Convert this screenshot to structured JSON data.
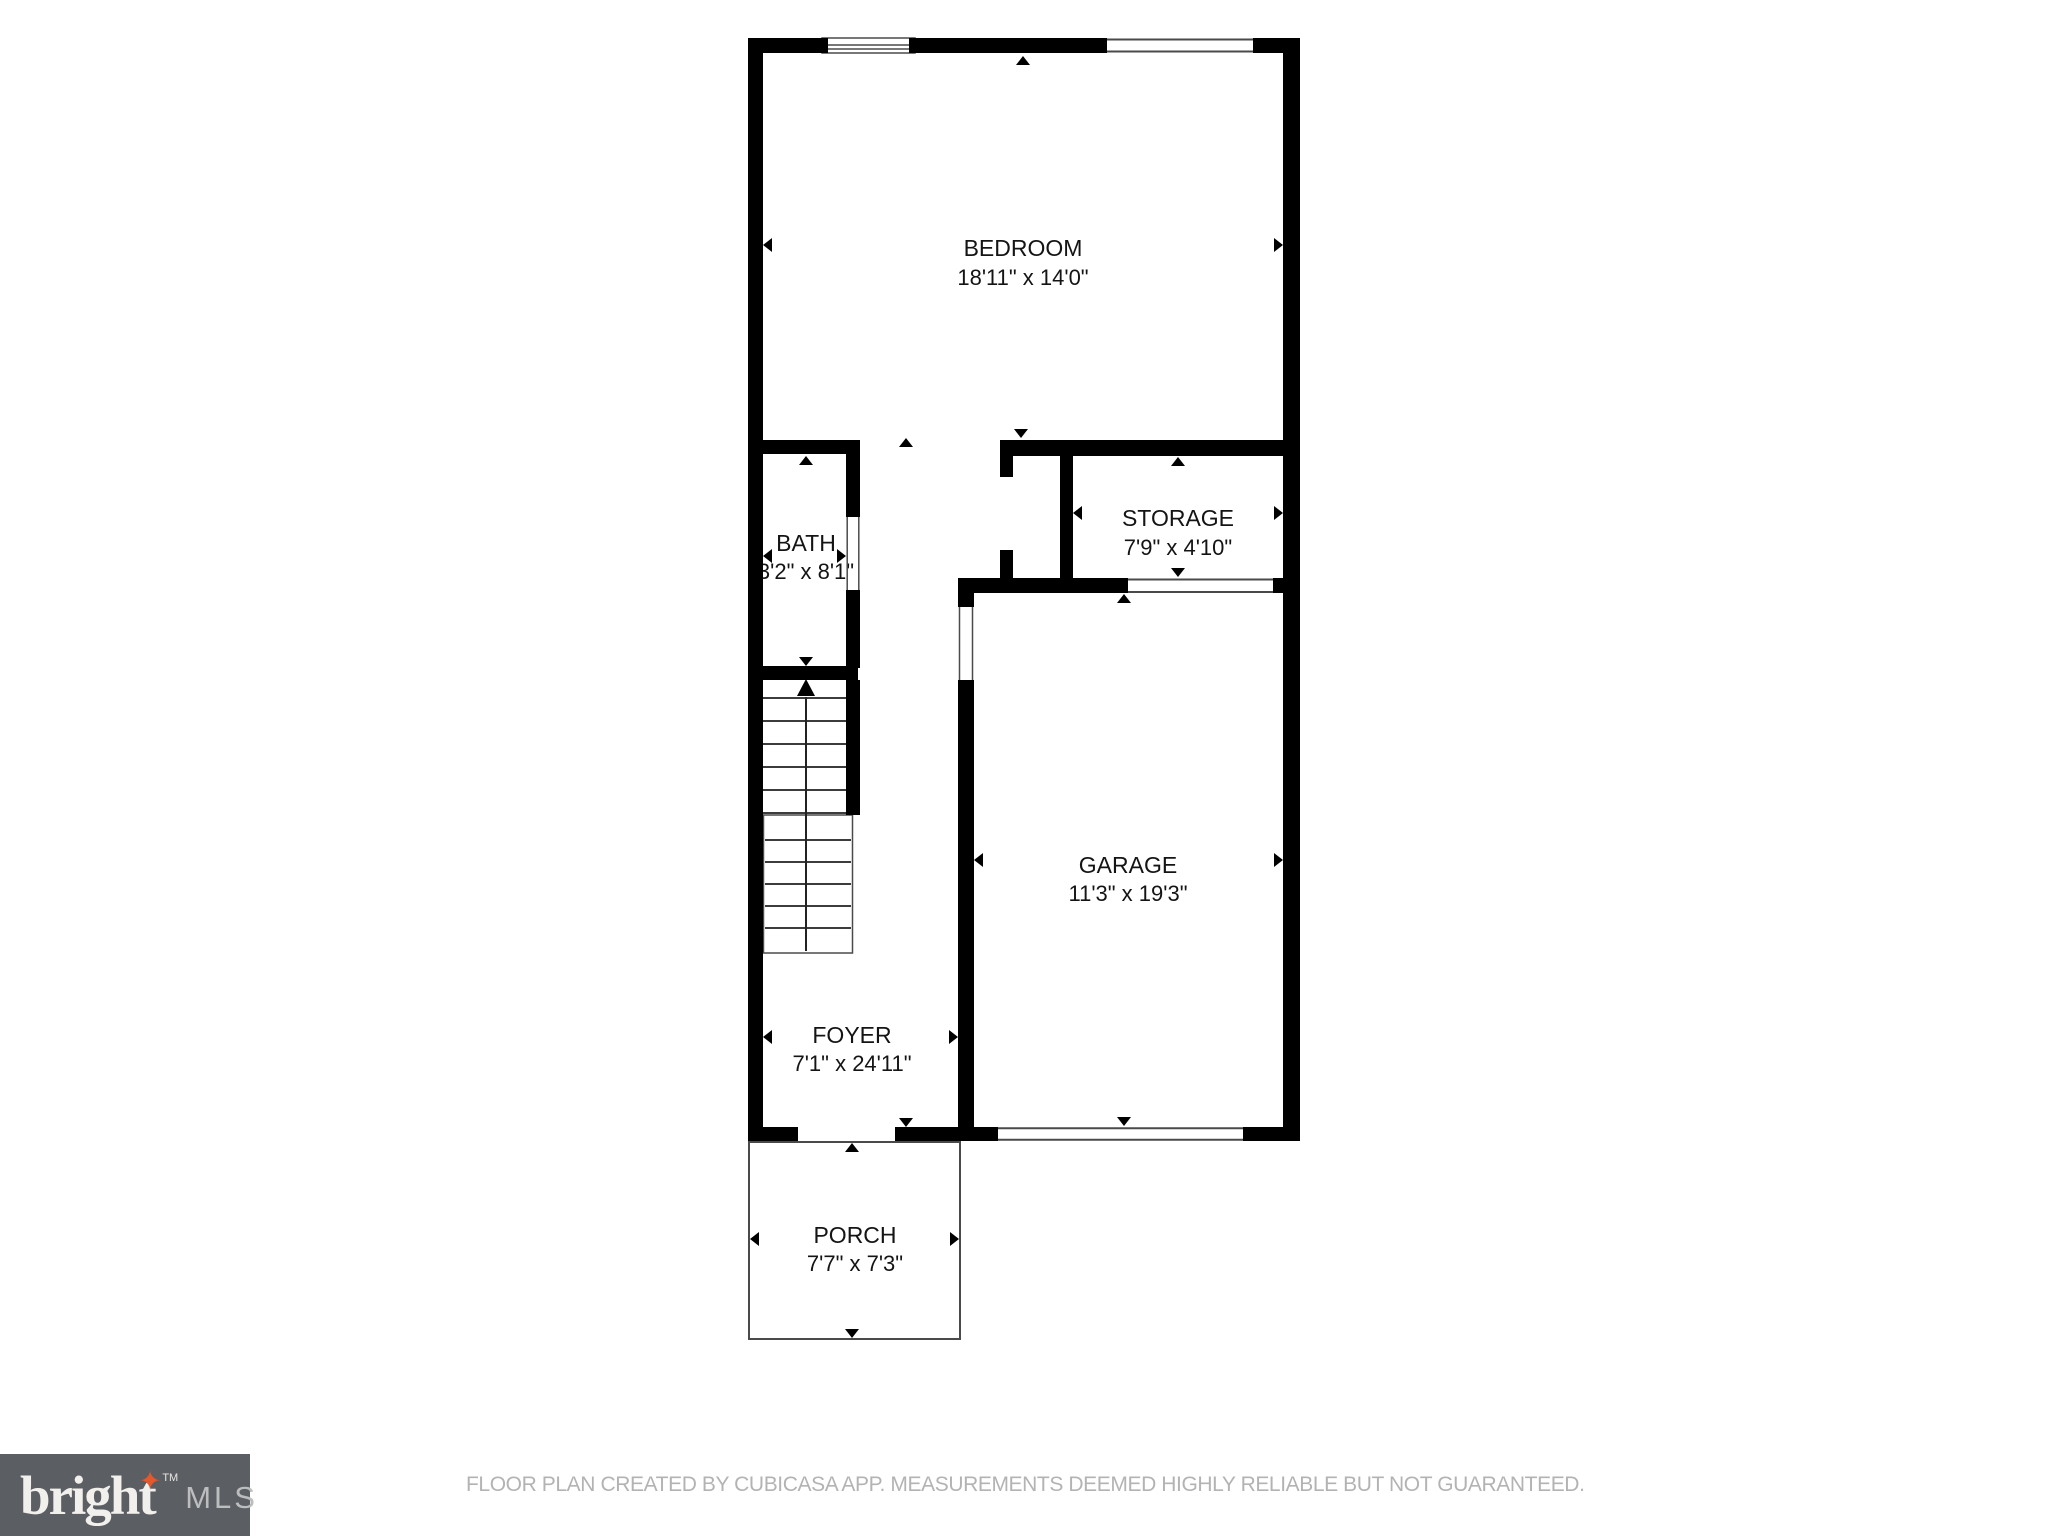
{
  "plan": {
    "source": "floor-plan",
    "rooms": [
      {
        "name": "BEDROOM",
        "dims": "18'11\" x 14'0\""
      },
      {
        "name": "BATH",
        "dims": "3'2\" x 8'1\""
      },
      {
        "name": "STORAGE",
        "dims": "7'9\" x 4'10\""
      },
      {
        "name": "GARAGE",
        "dims": "11'3\" x 19'3\""
      },
      {
        "name": "FOYER",
        "dims": "7'1\" x 24'11\""
      },
      {
        "name": "PORCH",
        "dims": "7'7\" x 7'3\""
      }
    ]
  },
  "branding": {
    "brand": "bright",
    "trademark": "TM",
    "star_icon": "✦",
    "suffix": "MLS"
  },
  "footer": {
    "disclaimer": "FLOOR PLAN CREATED BY CUBICASA APP. MEASUREMENTS DEEMED HIGHLY RELIABLE BUT NOT GUARANTEED."
  },
  "colors": {
    "wall": "#000000",
    "thin": "#4a4a4a",
    "label": "#141414",
    "footer": "#b3b3b3",
    "logo-bg": "#5b5e62",
    "logo-fg": "#f2f0ec",
    "logo-star": "#e4582b",
    "logo-mls": "#bbbdbe",
    "bg": "#ffffff"
  }
}
